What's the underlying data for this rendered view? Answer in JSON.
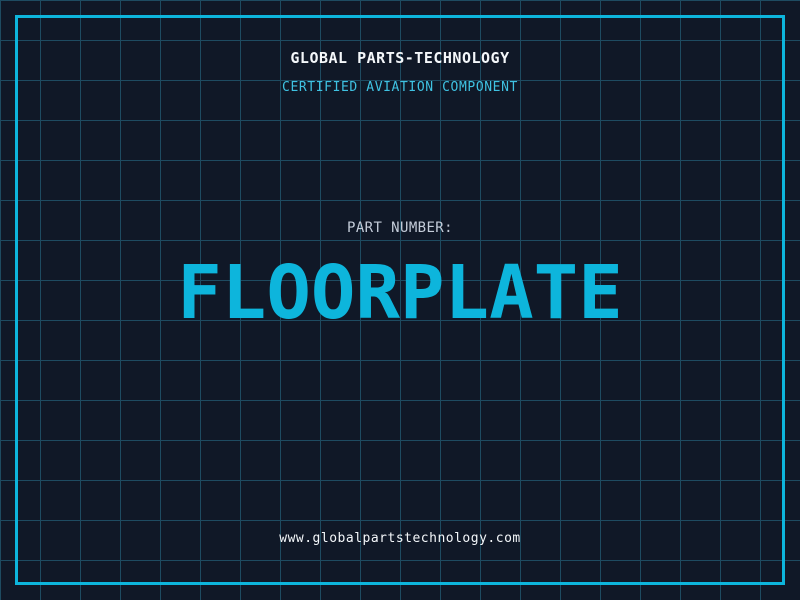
{
  "header": {
    "company_name": "GLOBAL PARTS-TECHNOLOGY",
    "tagline": "CERTIFIED AVIATION COMPONENT"
  },
  "part": {
    "label": "PART NUMBER:",
    "value": "FLOORPLATE"
  },
  "footer": {
    "website": "www.globalpartstechnology.com"
  },
  "colors": {
    "background": "#101827",
    "grid_line": "#1e4b61",
    "accent_cyan": "#0db5dc",
    "tagline_cyan": "#3fc2e2",
    "label_gray": "#c4ccd9",
    "text_white": "#f4f7fa"
  }
}
